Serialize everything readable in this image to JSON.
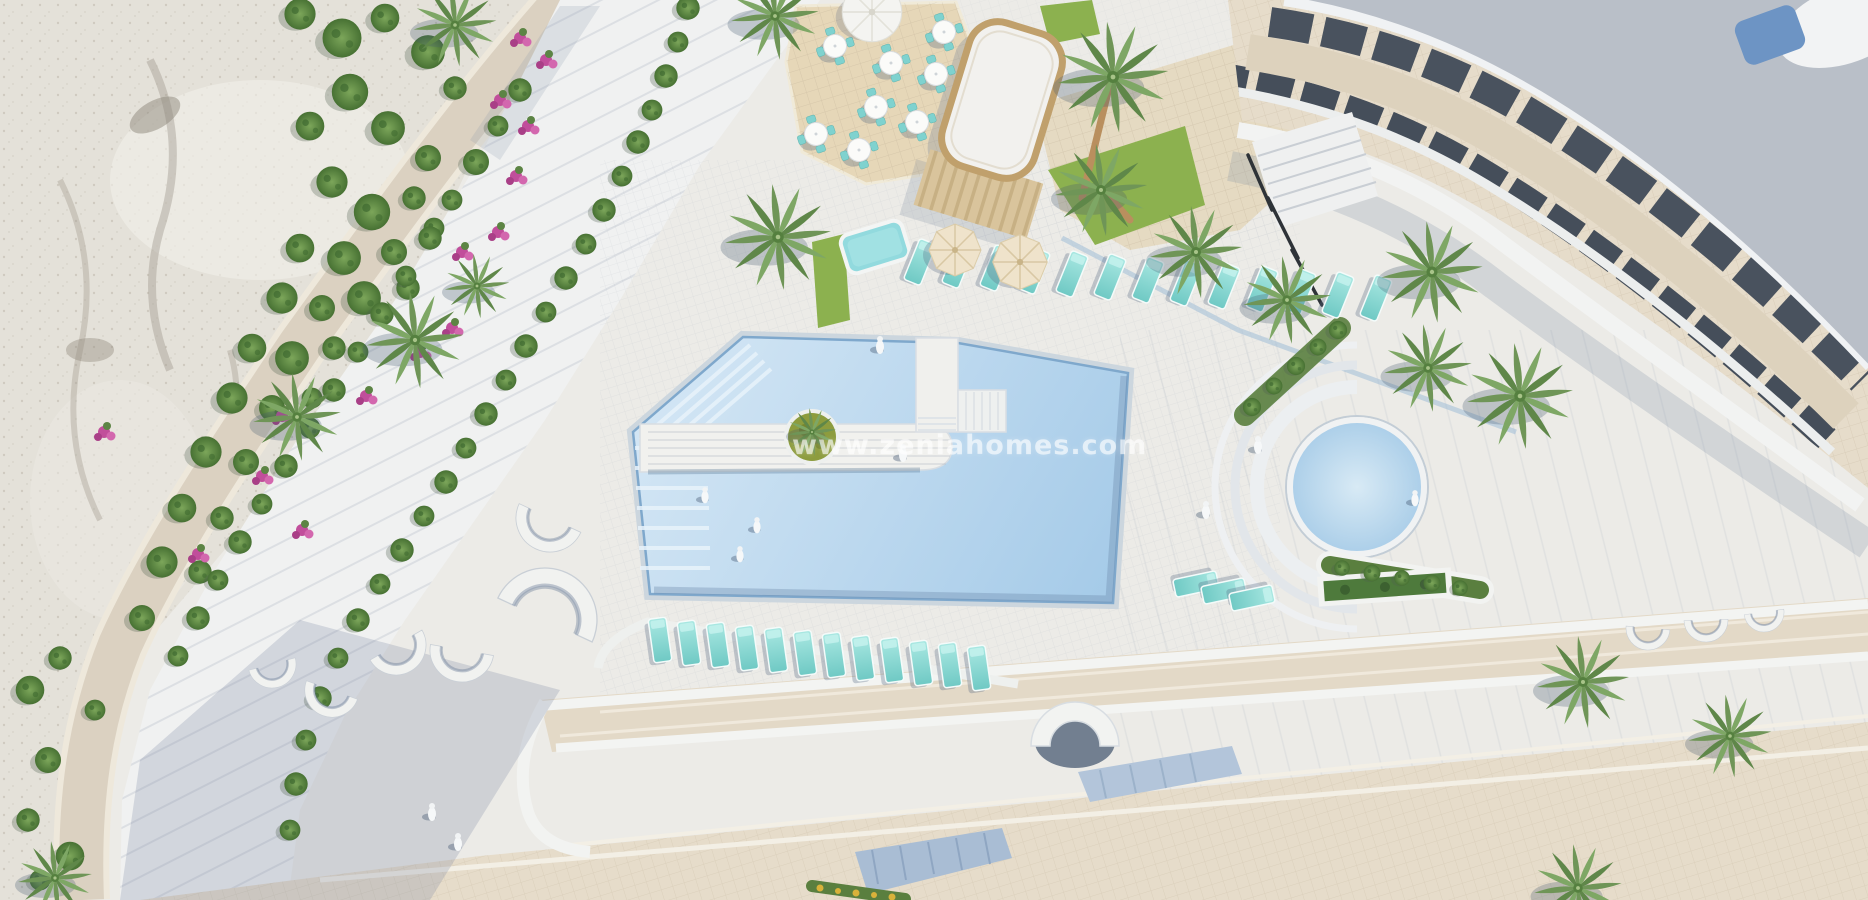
{
  "meta": {
    "type": "aerial-3d-architectural-render",
    "subject": "top-down view of a resort apartment complex with swimming pools, sun terraces, palm trees and a rocky hillside"
  },
  "watermark": {
    "text": "www.zeniahomes.com",
    "color": "#ffffff",
    "opacity": 0.62
  },
  "colors": {
    "base": "#ecebe7",
    "rock_light": "#e4e1d9",
    "rock_shadow": "#a49e92",
    "road_tan": "#dbd1c1",
    "walkway_white": "#f0f1f1",
    "terrace_beige": "#e3d9c7",
    "pool_blue_light": "#d5e7f5",
    "pool_blue_deep": "#a4cae8",
    "jacuzzi_blue": "#b3d4ea",
    "lounger_turquoise": "#8fdcd6",
    "grass_green": "#8cb14f",
    "shrub_green": "#568340",
    "bougainvillea_pink": "#c14e9b",
    "wood_tan": "#c0a06c",
    "roof_gray": "#b9bfc8",
    "window_dark": "#49525e",
    "skylight_blue": "#6d94c4",
    "shadow_blue": "rgba(120,135,160,0.25)"
  },
  "scene": {
    "palms": [
      [
        455,
        25,
        0.9
      ],
      [
        775,
        16,
        0.95
      ],
      [
        297,
        417,
        0.95
      ],
      [
        415,
        340,
        1.05
      ],
      [
        477,
        286,
        0.7
      ],
      [
        778,
        237,
        1.15
      ],
      [
        1113,
        77,
        1.2
      ],
      [
        1101,
        190,
        1.0
      ],
      [
        1196,
        252,
        1.0
      ],
      [
        1287,
        300,
        0.95
      ],
      [
        1432,
        272,
        1.1
      ],
      [
        1428,
        368,
        0.95
      ],
      [
        1520,
        396,
        1.15
      ],
      [
        1583,
        682,
        1.0
      ],
      [
        1730,
        736,
        0.9
      ],
      [
        1578,
        888,
        0.95
      ],
      [
        55,
        878,
        0.8
      ]
    ],
    "island_palm": [
      [
        812,
        432,
        0.52
      ]
    ],
    "shrubs": [
      [
        300,
        14,
        1.2
      ],
      [
        342,
        38,
        1.5
      ],
      [
        385,
        18,
        1.1
      ],
      [
        428,
        52,
        1.3
      ],
      [
        455,
        88,
        0.9
      ],
      [
        350,
        92,
        1.4
      ],
      [
        310,
        126,
        1.1
      ],
      [
        388,
        128,
        1.3
      ],
      [
        428,
        158,
        1.0
      ],
      [
        332,
        182,
        1.2
      ],
      [
        372,
        212,
        1.4
      ],
      [
        414,
        198,
        0.9
      ],
      [
        300,
        248,
        1.1
      ],
      [
        344,
        258,
        1.3
      ],
      [
        394,
        252,
        1.0
      ],
      [
        434,
        228,
        0.8
      ],
      [
        282,
        298,
        1.2
      ],
      [
        322,
        308,
        1.0
      ],
      [
        364,
        298,
        1.3
      ],
      [
        408,
        288,
        0.9
      ],
      [
        252,
        348,
        1.1
      ],
      [
        292,
        358,
        1.3
      ],
      [
        334,
        348,
        0.9
      ],
      [
        232,
        398,
        1.2
      ],
      [
        272,
        408,
        1.0
      ],
      [
        312,
        398,
        0.8
      ],
      [
        206,
        452,
        1.2
      ],
      [
        246,
        462,
        1.0
      ],
      [
        182,
        508,
        1.1
      ],
      [
        222,
        518,
        0.9
      ],
      [
        162,
        562,
        1.2
      ],
      [
        200,
        572,
        0.9
      ],
      [
        142,
        618,
        1.0
      ],
      [
        60,
        658,
        0.9
      ],
      [
        30,
        690,
        1.1
      ],
      [
        95,
        710,
        0.8
      ],
      [
        48,
        760,
        1.0
      ],
      [
        28,
        820,
        0.9
      ],
      [
        70,
        856,
        1.1
      ],
      [
        40,
        880,
        0.8
      ],
      [
        688,
        8,
        0.9
      ],
      [
        678,
        42,
        0.8
      ],
      [
        666,
        76,
        0.9
      ],
      [
        652,
        110,
        0.8
      ],
      [
        638,
        142,
        0.9
      ],
      [
        622,
        176,
        0.8
      ],
      [
        604,
        210,
        0.9
      ],
      [
        586,
        244,
        0.8
      ],
      [
        566,
        278,
        0.9
      ],
      [
        546,
        312,
        0.8
      ],
      [
        526,
        346,
        0.9
      ],
      [
        506,
        380,
        0.8
      ],
      [
        486,
        414,
        0.9
      ],
      [
        466,
        448,
        0.8
      ],
      [
        446,
        482,
        0.9
      ],
      [
        424,
        516,
        0.8
      ],
      [
        402,
        550,
        0.9
      ],
      [
        380,
        584,
        0.8
      ],
      [
        358,
        620,
        0.9
      ],
      [
        338,
        658,
        0.8
      ],
      [
        320,
        698,
        0.9
      ],
      [
        306,
        740,
        0.8
      ],
      [
        296,
        784,
        0.9
      ],
      [
        290,
        830,
        0.8
      ],
      [
        520,
        90,
        0.9
      ],
      [
        498,
        126,
        0.8
      ],
      [
        476,
        162,
        1.0
      ],
      [
        452,
        200,
        0.8
      ],
      [
        430,
        238,
        0.9
      ],
      [
        406,
        276,
        0.8
      ],
      [
        382,
        314,
        0.9
      ],
      [
        358,
        352,
        0.8
      ],
      [
        334,
        390,
        0.9
      ],
      [
        310,
        428,
        0.8
      ],
      [
        286,
        466,
        0.9
      ],
      [
        262,
        504,
        0.8
      ],
      [
        240,
        542,
        0.9
      ],
      [
        218,
        580,
        0.8
      ],
      [
        198,
        618,
        0.9
      ],
      [
        178,
        656,
        0.8
      ],
      [
        1252,
        407,
        0.7
      ],
      [
        1274,
        386,
        0.65
      ],
      [
        1296,
        366,
        0.7
      ],
      [
        1318,
        347,
        0.65
      ],
      [
        1338,
        330,
        0.7
      ],
      [
        1342,
        568,
        0.6
      ],
      [
        1372,
        573,
        0.65
      ],
      [
        1402,
        578,
        0.6
      ],
      [
        1432,
        583,
        0.65
      ],
      [
        1460,
        588,
        0.6
      ]
    ],
    "flowers": [
      [
        520,
        38
      ],
      [
        546,
        60
      ],
      [
        500,
        100
      ],
      [
        528,
        126
      ],
      [
        516,
        176
      ],
      [
        498,
        232
      ],
      [
        462,
        252
      ],
      [
        452,
        328
      ],
      [
        420,
        352
      ],
      [
        366,
        396
      ],
      [
        282,
        416
      ],
      [
        262,
        476
      ],
      [
        198,
        554
      ],
      [
        104,
        432
      ],
      [
        302,
        530
      ]
    ],
    "loungers_top": [
      [
        920,
        262,
        1,
        22
      ],
      [
        958,
        265,
        1,
        22
      ],
      [
        996,
        268,
        1,
        22
      ],
      [
        1034,
        271,
        1,
        22
      ],
      [
        1072,
        274,
        1,
        22
      ],
      [
        1110,
        277,
        1,
        22
      ],
      [
        1148,
        280,
        1,
        22
      ],
      [
        1186,
        283,
        1,
        22
      ],
      [
        1224,
        286,
        1,
        22
      ],
      [
        1262,
        289,
        1,
        22
      ],
      [
        1300,
        292,
        1,
        22
      ],
      [
        1338,
        295,
        1,
        22
      ],
      [
        1376,
        298,
        1,
        22
      ]
    ],
    "loungers_bottom": [
      [
        660,
        640,
        1,
        -8
      ],
      [
        689,
        643,
        1,
        -8
      ],
      [
        718,
        645,
        1,
        -8
      ],
      [
        747,
        648,
        1,
        -8
      ],
      [
        776,
        650,
        1,
        -8
      ],
      [
        805,
        653,
        1,
        -8
      ],
      [
        834,
        655,
        1,
        -8
      ],
      [
        863,
        658,
        1,
        -8
      ],
      [
        892,
        660,
        1,
        -8
      ],
      [
        921,
        663,
        1,
        -8
      ],
      [
        950,
        665,
        1,
        -8
      ],
      [
        979,
        668,
        1,
        -8
      ]
    ],
    "loungers_side": [
      [
        1196,
        584,
        1,
        78
      ],
      [
        1224,
        591,
        1,
        78
      ],
      [
        1252,
        598,
        1,
        78
      ]
    ],
    "tables": [
      [
        835,
        46,
        1,
        -18
      ],
      [
        891,
        63,
        1,
        -18
      ],
      [
        944,
        32,
        1,
        -18
      ],
      [
        936,
        74,
        1,
        -18
      ],
      [
        876,
        107,
        1,
        -18
      ],
      [
        917,
        122,
        1,
        -18
      ],
      [
        816,
        134,
        1,
        -18
      ],
      [
        859,
        150,
        1,
        -18
      ]
    ],
    "parasols": [
      [
        955,
        250,
        1,
        0
      ],
      [
        1020,
        262,
        1.05,
        0
      ]
    ],
    "parasols_white": [
      [
        872,
        12,
        1.1,
        0
      ]
    ],
    "arc_walls": [
      [
        545,
        620,
        1.3,
        25
      ],
      [
        550,
        518,
        0.85,
        205
      ],
      [
        462,
        650,
        0.8,
        190
      ],
      [
        396,
        645,
        0.75,
        150
      ],
      [
        332,
        690,
        0.68,
        200
      ],
      [
        272,
        664,
        0.6,
        165
      ],
      [
        1648,
        628,
        0.55,
        185
      ],
      [
        1706,
        620,
        0.55,
        178
      ],
      [
        1764,
        612,
        0.5,
        172
      ]
    ],
    "people": [
      [
        757,
        527,
        0.9,
        0
      ],
      [
        740,
        556,
        0.9,
        0
      ],
      [
        705,
        497,
        0.9,
        0
      ],
      [
        903,
        455,
        1,
        0
      ],
      [
        1258,
        447,
        1,
        0
      ],
      [
        1206,
        512,
        1,
        0
      ],
      [
        1415,
        500,
        0.9,
        0
      ],
      [
        880,
        347,
        1,
        0
      ],
      [
        432,
        814,
        1,
        0
      ],
      [
        458,
        844,
        1,
        0
      ]
    ]
  }
}
